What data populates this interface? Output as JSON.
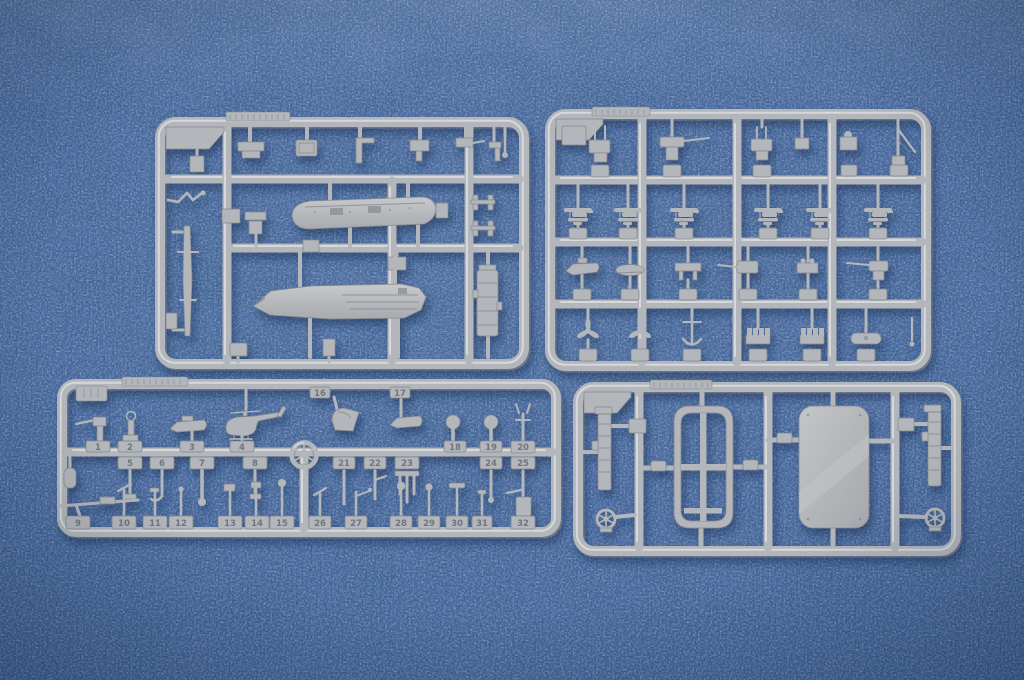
{
  "scene": {
    "subject": "Four light-grey injection-moulded plastic model kit sprues photographed on blue fabric",
    "sprue_count": "4"
  },
  "colors": {
    "bg": "#44659b",
    "bg_light": "#5a7aa8",
    "bg_dark": "#2c4875",
    "plastic": "#b3b6ba",
    "plastic_hi": "#dcdee0",
    "plastic_lo": "#84898f",
    "shadow": "#132b50"
  },
  "sprue_c": {
    "tabs": [
      "1",
      "2",
      "3",
      "4",
      "5",
      "6",
      "7",
      "8",
      "9",
      "10",
      "11",
      "12",
      "13",
      "14",
      "15",
      "16",
      "17",
      "18",
      "19",
      "20",
      "21",
      "22",
      "23",
      "24",
      "25",
      "26",
      "27",
      "28",
      "29",
      "30",
      "31",
      "32"
    ]
  }
}
